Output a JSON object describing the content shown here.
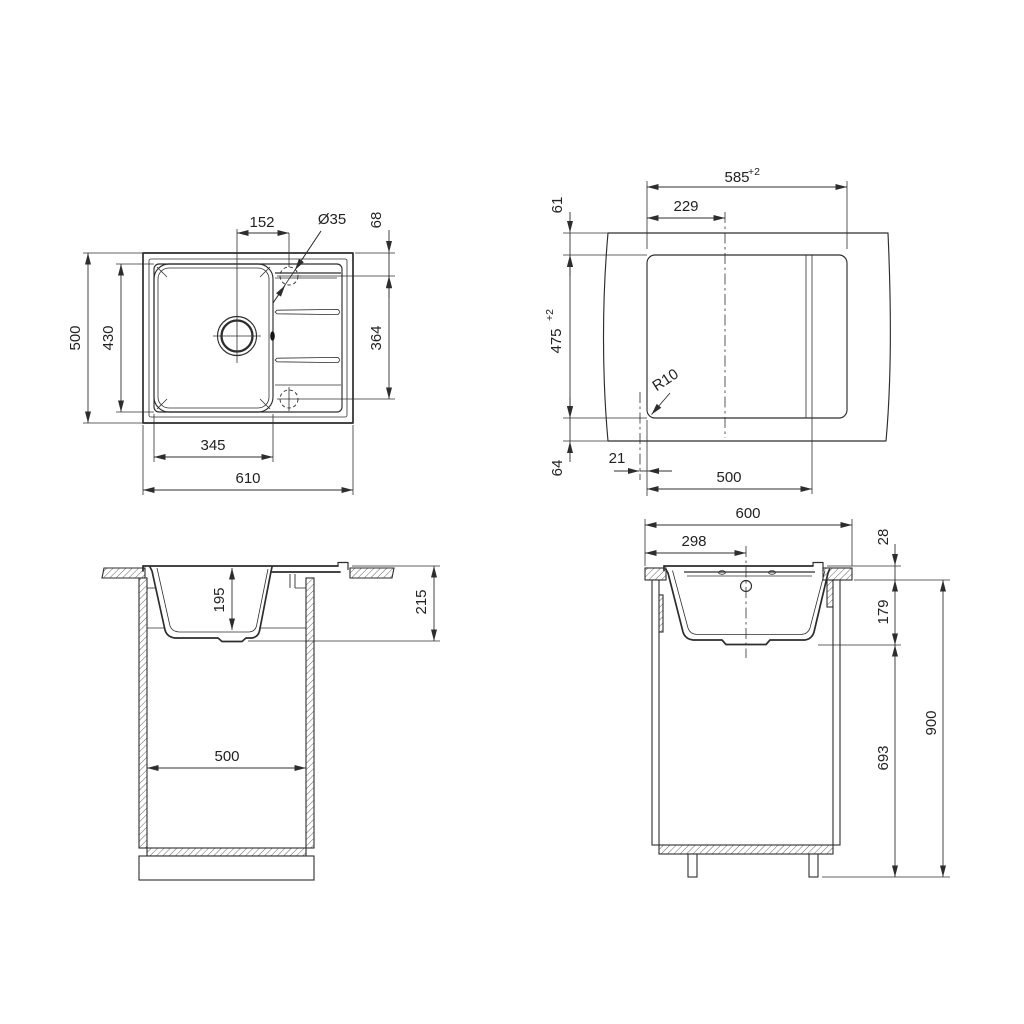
{
  "drawing": {
    "type": "technical-dimension-drawing",
    "subject": "kitchen sink with drainboard - installation dimensions, four orthographic views",
    "background_color": "#ffffff",
    "line_color": "#2d2d2d"
  },
  "views": {
    "top_view": {
      "title": "sink top view",
      "dims": {
        "drain_to_hole": "152",
        "hole_diameter": "Ø35",
        "hole_top_offset": "68",
        "overall_depth": "500",
        "bowl_depth": "430",
        "holes_span": "364",
        "bowl_width": "345",
        "overall_width": "610"
      }
    },
    "cutout_view": {
      "title": "countertop cutout view",
      "dims": {
        "cutout_width": "585",
        "cutout_width_tol": "+2",
        "center_offset": "229",
        "top_clearance": "61",
        "cutout_depth": "475",
        "cutout_depth_tol": "+2",
        "corner_radius": "R10",
        "bottom_clearance": "64",
        "edge_offset": "21",
        "groove_span": "500"
      }
    },
    "front_view": {
      "title": "front section view",
      "dims": {
        "bowl_inner_depth": "195",
        "total_depth": "215",
        "cabinet_inner_width": "500"
      }
    },
    "side_view": {
      "title": "side section view",
      "dims": {
        "cabinet_width": "600",
        "center_offset": "298",
        "rim_height": "28",
        "under_counter_depth": "179",
        "clearance_height": "693",
        "total_height": "900"
      }
    }
  }
}
